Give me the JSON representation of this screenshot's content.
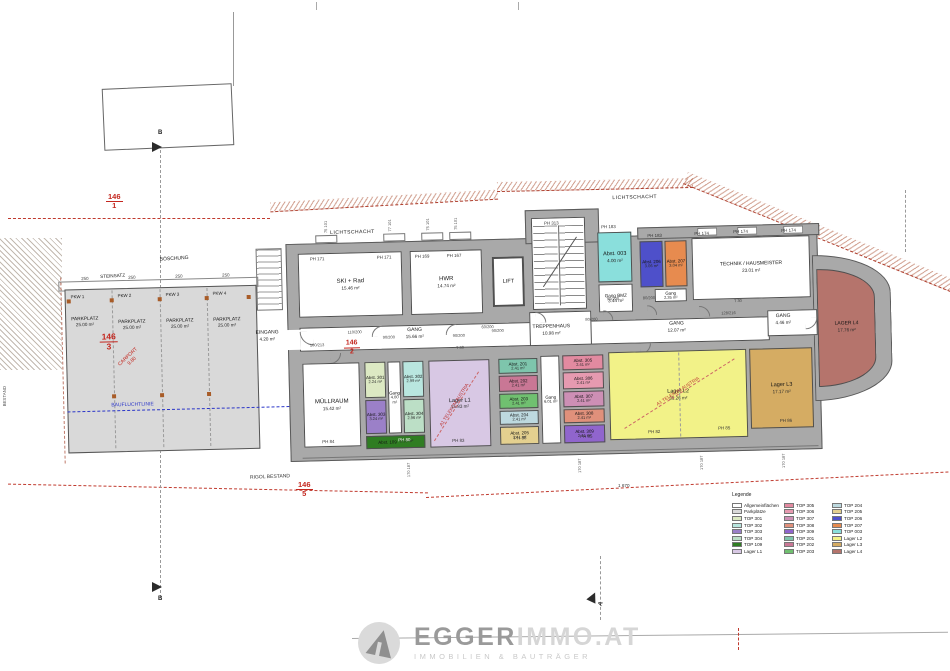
{
  "colors": {
    "wall": "#a9a9a9",
    "parking": "#d9d9d9",
    "allgemein": "#ffffff",
    "top301": "#dce9c3",
    "top302": "#b9e6df",
    "top303": "#9b80c8",
    "top304": "#bcdfc6",
    "top109": "#2f7d22",
    "lagerL1": "#d8c8e4",
    "top305": "#e28aa0",
    "top306": "#e69ab0",
    "top307": "#cd8fb5",
    "top308": "#e0907b",
    "top309": "#9065cd",
    "top201": "#7ec5ac",
    "top202": "#c97795",
    "top203": "#70c070",
    "top204": "#bdd9df",
    "top205": "#e4d08f",
    "top206": "#4e50ca",
    "top207": "#e78b4f",
    "top003": "#8adfdc",
    "lagerL2": "#f2f288",
    "lagerL3": "#d5ac63",
    "lagerL4": "#b5746c",
    "parcel_red": "#c4271f",
    "boundary_red": "#c03a2e",
    "bauflucht_blue": "#2a35c8"
  },
  "texts": {
    "lichtschacht": "LICHTSCHACHT",
    "boeschung": "BÖSCHUNG",
    "steinsatz": "STEINSATZ",
    "bauflucht": "BAUFLUCHTLINIE",
    "carport": "CARPORT",
    "carport_len": "9.80",
    "telekom": "A1 TELEKOM AUSTRIA",
    "rigol": "RIGOL BESTAND",
    "bestand": "BESTAND",
    "dim250": "250",
    "dim_total": "1 670",
    "dim_top": "75 101",
    "dim_top2": "77 101",
    "dim_bottom": "170 187",
    "t30": "T 30",
    "section_b": "B",
    "section_a": "A"
  },
  "parzellen": {
    "p1": {
      "num": "146",
      "sub": "1"
    },
    "p2": {
      "num": "146",
      "sub": "2"
    },
    "p3": {
      "num": "146",
      "sub": "3"
    },
    "p5": {
      "num": "146",
      "sub": "5"
    }
  },
  "parking": {
    "stalls": [
      {
        "id": "PKW 1",
        "name": "PARKPLATZ",
        "area": "25.00 m²"
      },
      {
        "id": "PKW 2",
        "name": "PARKPLATZ",
        "area": "25.00 m²"
      },
      {
        "id": "PKW 3",
        "name": "PARKPLATZ",
        "area": "25.00 m²"
      },
      {
        "id": "PKW 4",
        "name": "PARKPLATZ",
        "area": "25.00 m²"
      }
    ]
  },
  "rooms": {
    "ski": {
      "name": "SKI + Rad",
      "area": "15.46 m²"
    },
    "hwr": {
      "name": "HWR",
      "area": "14.74 m²"
    },
    "lift": {
      "name": "LIFT",
      "area": ""
    },
    "trepp": {
      "name": "TREPPENHAUS",
      "area": "10.98 m²"
    },
    "abst003": {
      "name": "Abst. 003",
      "area": "4.00 m²"
    },
    "gangbmz": {
      "name": "Gang BMZ",
      "area": "3.44 m²"
    },
    "abst206": {
      "name": "Abst. 206",
      "area": "3.06 m²"
    },
    "abst207": {
      "name": "Abst. 207",
      "area": "3.04 m²"
    },
    "gang235": {
      "name": "Gang",
      "area": "2.35 m²"
    },
    "technik": {
      "name": "TECHNIK / HAUSMEISTER",
      "area": "23.01 m²"
    },
    "eingang": {
      "name": "EINGANG",
      "area": "4.20 m²"
    },
    "gang1566": {
      "name": "GANG",
      "area": "15.66 m²"
    },
    "gang1207": {
      "name": "GANG",
      "area": "12.07 m²"
    },
    "gang446": {
      "name": "GANG",
      "area": "4.46 m²"
    },
    "muell": {
      "name": "MÜLLRAUM",
      "area": "15.42 m²"
    },
    "abst301": {
      "name": "Abst. 301",
      "area": "2.24 m²"
    },
    "abst302": {
      "name": "Abst. 302",
      "area": "2.99 m²"
    },
    "gang400": {
      "name": "Gang",
      "area": "4.00 m²"
    },
    "abst303": {
      "name": "Abst. 303",
      "area": "3.24 m²"
    },
    "abst304": {
      "name": "Abst. 304",
      "area": "2.96 m²"
    },
    "abst109": {
      "name": "Abst. 109",
      "area": "3.53 m²"
    },
    "lagerl1": {
      "name": "Lager L1",
      "area": "15.83 m²"
    },
    "abst201": {
      "name": "Abst. 201",
      "area": "2.41 m²"
    },
    "abst202": {
      "name": "Abst. 202",
      "area": "2.41 m²"
    },
    "abst203": {
      "name": "Abst. 203",
      "area": "2.41 m²"
    },
    "abst204": {
      "name": "Abst. 204",
      "area": "2.41 m²"
    },
    "abst205": {
      "name": "Abst. 205",
      "area": "2.41 m²"
    },
    "gang601": {
      "name": "Gang",
      "area": "6.01 m²"
    },
    "abst305": {
      "name": "Abst. 305",
      "area": "2.41 m²"
    },
    "abst306": {
      "name": "Abst. 306",
      "area": "2.41 m²"
    },
    "abst307": {
      "name": "Abst. 307",
      "area": "2.41 m²"
    },
    "abst308": {
      "name": "Abst. 308",
      "area": "2.41 m²"
    },
    "abst309": {
      "name": "Abst. 309",
      "area": "2.41 m²"
    },
    "lagerl2": {
      "name": "Lager L2",
      "area": "36.26 m²"
    },
    "lagerl3": {
      "name": "Lager L3",
      "area": "17.17 m²"
    },
    "lagerl4": {
      "name": "LAGER L4",
      "area": "17.76 m²"
    }
  },
  "ph": [
    "PH 171",
    "PH 171",
    "PH 169",
    "PH 167",
    "PH 313",
    "PH 183",
    "PH 183",
    "PH 174",
    "PH 174",
    "PH 174",
    "PH 84",
    "PH 80",
    "PH 83",
    "PH 88",
    "PH 85",
    "PH 82",
    "PH 85",
    "PH 86"
  ],
  "doors": [
    "110/200",
    "100/213",
    "90/200",
    "90/200",
    "60/200",
    "90/200",
    "80/200",
    "80/200",
    "128/216",
    "90/200"
  ],
  "legend": {
    "title": "Legende",
    "col1": [
      {
        "label": "Allgemeinflächen",
        "color": "#ffffff"
      },
      {
        "label": "Parkplätze",
        "color": "#d9d9d9"
      },
      {
        "label": "TOP 301",
        "color": "#dce9c3"
      },
      {
        "label": "TOP 302",
        "color": "#b9e6df"
      },
      {
        "label": "TOP 303",
        "color": "#9b80c8"
      },
      {
        "label": "TOP 304",
        "color": "#bcdfc6"
      },
      {
        "label": "TOP 109",
        "color": "#2f7d22"
      },
      {
        "label": "Lager L1",
        "color": "#d8c8e4"
      }
    ],
    "col2": [
      {
        "label": "TOP 305",
        "color": "#e28aa0"
      },
      {
        "label": "TOP 306",
        "color": "#e69ab0"
      },
      {
        "label": "TOP 307",
        "color": "#cd8fb5"
      },
      {
        "label": "TOP 308",
        "color": "#e0907b"
      },
      {
        "label": "TOP 309",
        "color": "#9065cd"
      },
      {
        "label": "TOP 201",
        "color": "#7ec5ac"
      },
      {
        "label": "TOP 202",
        "color": "#c97795"
      },
      {
        "label": "TOP 203",
        "color": "#70c070"
      }
    ],
    "col3": [
      {
        "label": "TOP 204",
        "color": "#bdd9df"
      },
      {
        "label": "TOP 205",
        "color": "#e4d08f"
      },
      {
        "label": "TOP 206",
        "color": "#4e50ca"
      },
      {
        "label": "TOP 207",
        "color": "#e78b4f"
      },
      {
        "label": "TOP 003",
        "color": "#8adfdc"
      },
      {
        "label": "Lager L2",
        "color": "#f2f288"
      },
      {
        "label": "Lager L3",
        "color": "#d5ac63"
      },
      {
        "label": "Lager L4",
        "color": "#b5746c"
      }
    ]
  },
  "logo": {
    "brand_a": "EGGER",
    "brand_b": "IMMO",
    "brand_c": ".AT",
    "tagline": "IMMOBILIEN & BAUTRÄGER"
  }
}
